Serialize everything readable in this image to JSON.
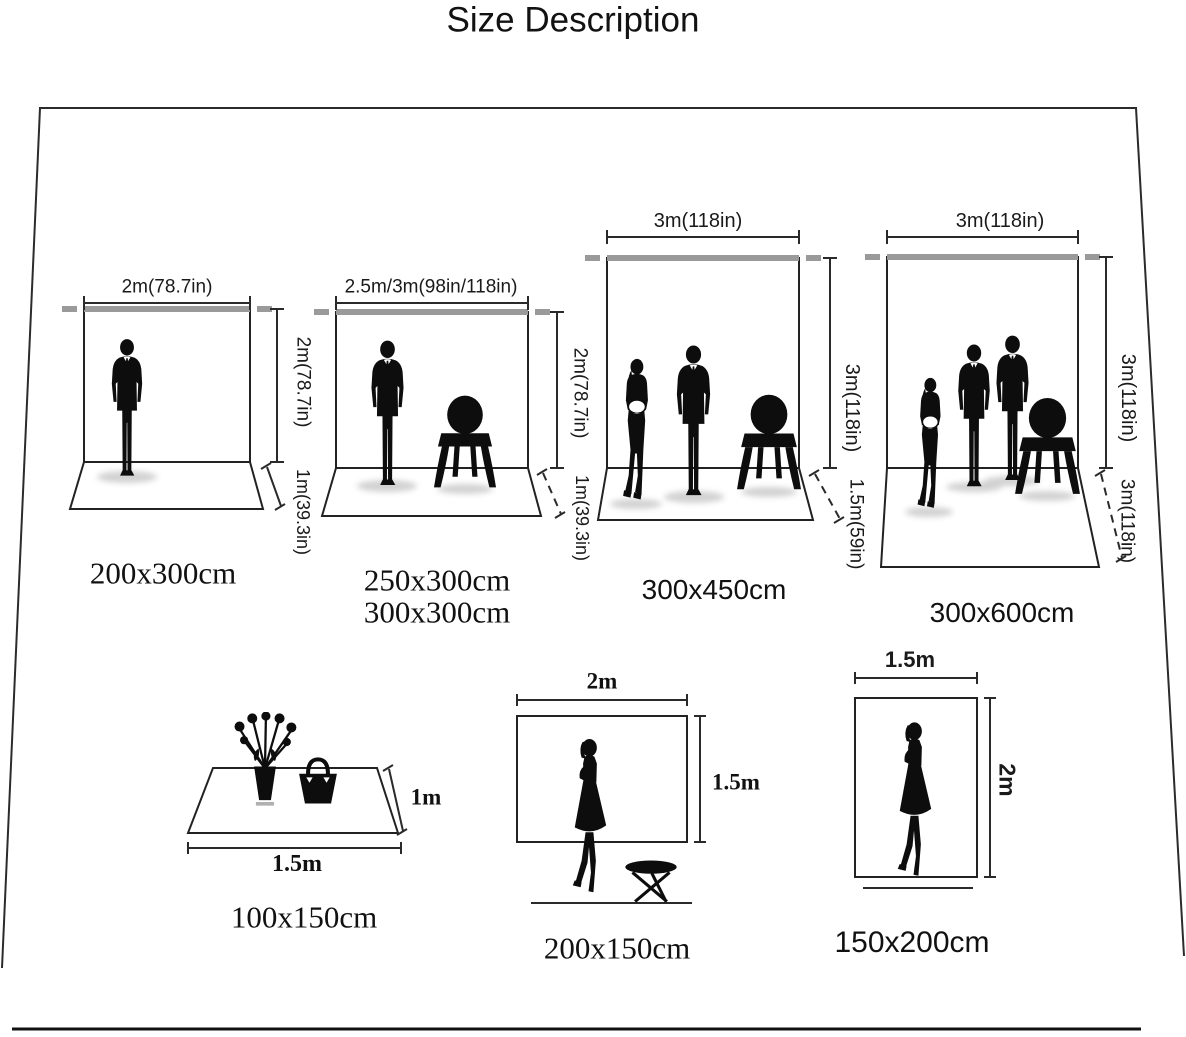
{
  "title": "Size Description",
  "colors": {
    "ink": "#1a1a1a",
    "pole_gray": "#9a9a9a"
  },
  "backdrops": [
    {
      "width_label": "2m(78.7in)",
      "height_label": "2m(78.7in)",
      "depth_label": "1m(39.3in)",
      "size_labels": [
        "200x300cm"
      ]
    },
    {
      "width_label": "2.5m/3m(98in/118in)",
      "height_label": "2m(78.7in)",
      "depth_label": "1m(39.3in)",
      "size_labels": [
        "250x300cm",
        "300x300cm"
      ]
    },
    {
      "width_label": "3m(118in)",
      "height_label": "3m(118in)",
      "depth_label": "1.5m(59in)",
      "size_labels": [
        "300x450cm"
      ]
    },
    {
      "width_label": "3m(118in)",
      "height_label": "3m(118in)",
      "depth_label": "3m(118in)",
      "size_labels": [
        "300x600cm"
      ]
    }
  ],
  "flats": [
    {
      "width_label": "1.5m",
      "depth_label": "1m",
      "size_label": "100x150cm"
    },
    {
      "width_label": "2m",
      "height_label": "1.5m",
      "size_label": "200x150cm"
    },
    {
      "width_label": "1.5m",
      "height_label": "2m",
      "size_label": "150x200cm"
    }
  ]
}
